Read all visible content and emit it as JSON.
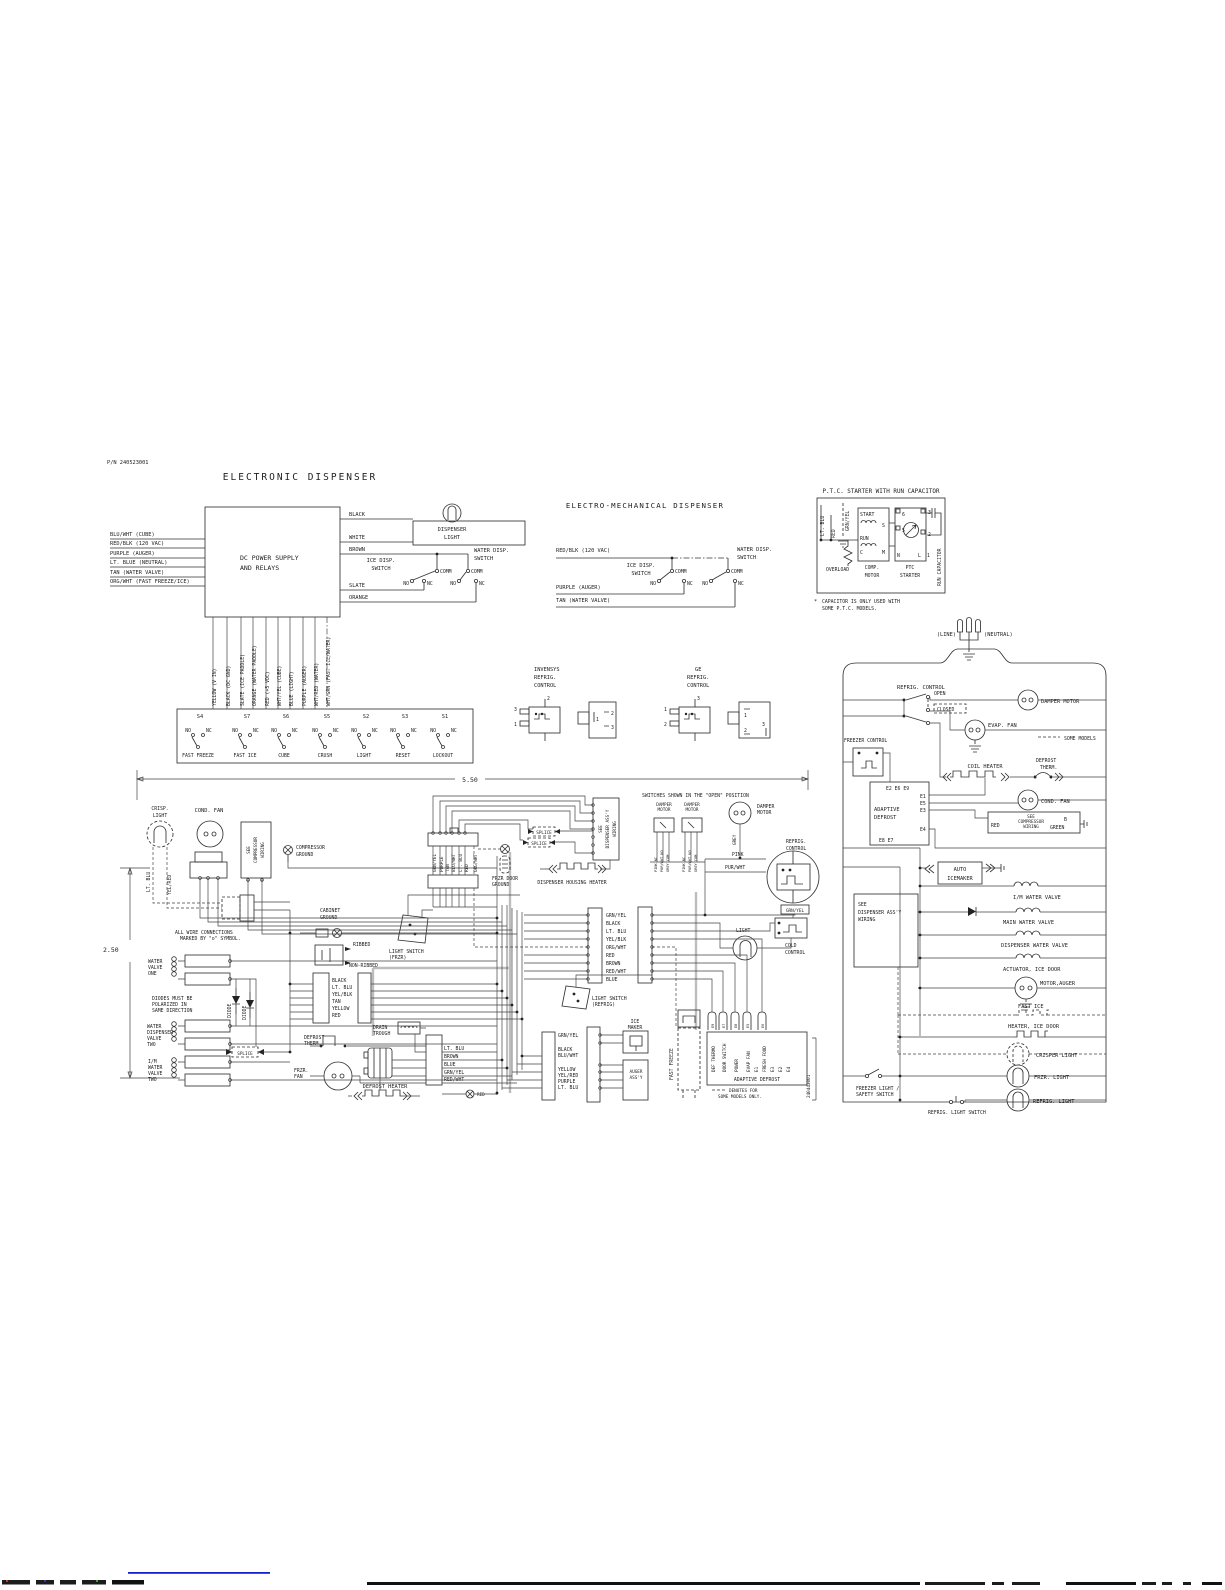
{
  "ed": {
    "pn": "P/N 240523001",
    "title": "ELECTRONIC DISPENSER",
    "box_line1": "DC POWER SUPPLY",
    "box_line2": "AND RELAYS",
    "left_wires": [
      "BLU/WHT (CUBE)",
      "RED/BLK (120 VAC)",
      "PURPLE (AUGER)",
      "LT. BLUE (NEUTRAL)",
      "TAN (WATER VALVE)",
      "ORG/WHT (FAST FREEZE/ICE)"
    ],
    "right_wires": [
      "BLACK",
      "WHITE",
      "BROWN",
      "SLATE",
      "ORANGE"
    ],
    "disp_light1": "DISPENSER",
    "disp_light2": "LIGHT",
    "ice_sw1": "ICE DISP.",
    "ice_sw2": "SWITCH",
    "water_sw1": "WATER DISP.",
    "water_sw2": "SWITCH",
    "comm": "COMM",
    "no": "NO",
    "nc": "NC",
    "bottom_wires": [
      "YELLOW (V IN)",
      "BLACK (DC GND)",
      "SLATE (ICE PADDLE)",
      "ORANGE (WATER PADDLE)",
      "RED (+5 VDC)",
      "WHT/YEL (CUBE)",
      "BLUE (LIGHT)",
      "PURPLE (AUGER)",
      "WHT/RED (WATER)",
      "WHT/GRN (FAST ICE/WATER)"
    ],
    "switches": [
      {
        "id": "S4",
        "label": "FAST FREEZE"
      },
      {
        "id": "S7",
        "label": "FAST ICE"
      },
      {
        "id": "S6",
        "label": "CUBE"
      },
      {
        "id": "S5",
        "label": "CRUSH"
      },
      {
        "id": "S2",
        "label": "LIGHT"
      },
      {
        "id": "S3",
        "label": "RESET"
      },
      {
        "id": "S1",
        "label": "LOCKOUT"
      }
    ]
  },
  "emd": {
    "title": "ELECTRO-MECHANICAL DISPENSER",
    "wire1": "RED/BLK (120 VAC)",
    "wire2": "PURPLE (AUGER)",
    "wire3": "TAN (WATER VALVE)"
  },
  "ptc": {
    "title": "P.T.C. STARTER WITH RUN CAPACITOR",
    "lt_blu": "LT. BLU",
    "red": "RED",
    "grn_yel": "GRN/YEL",
    "overload": "OVERLOAD",
    "start": "START",
    "run": "RUN",
    "s": "S",
    "c": "C",
    "m": "M",
    "n": "N",
    "l": "L",
    "t1": "1",
    "t2": "2",
    "t3": "3",
    "t5": "5",
    "t6": "6",
    "comp1": "COMP.",
    "comp2": "MOTOR",
    "ptc1": "PTC",
    "ptc2": "STARTER",
    "run_cap": "RUN CAPACITOR",
    "star": "*",
    "note1": "CAPACITOR IS ONLY USED WITH",
    "note2": "SOME P.T.C. MODELS."
  },
  "ctl": {
    "inv": "INVENSYS",
    "refrig": "REFRIG.",
    "control": "CONTROL",
    "ge": "GE",
    "n1": "1",
    "n2": "2",
    "n3": "3"
  },
  "cab": {
    "dim_w": "5.50",
    "dim_h": "2.50",
    "crisp1": "CRISP.",
    "crisp2": "LIGHT",
    "lt_blu": "LT. BLU",
    "yel_red": "YEL/RED",
    "cond_fan": "COND. FAN",
    "see_comp1": "SEE",
    "see_comp2": "COMPRESSOR",
    "see_comp3": "WIRING",
    "comp_gnd1": "COMPRESSOR",
    "comp_gnd2": "GROUND",
    "cab_gnd1": "CABINET",
    "cab_gnd2": "GROUND",
    "wire_note1": "ALL WIRE CONNECTIONS",
    "wire_note2": "MARKED BY \"o\" SYMBOL.",
    "wv1": [
      "WATER",
      "VALVE",
      "ONE"
    ],
    "diode_note1": "DIODES MUST BE",
    "diode_note2": "POLARIZED IN",
    "diode_note3": "SAME DIRECTION",
    "diode": "DIODE",
    "wv2": [
      "WATER",
      "DISPENSER",
      "VALVE",
      "TWO"
    ],
    "wv3": [
      "I/M",
      "WATER",
      "VALVE",
      "TWO"
    ],
    "splice": "SPLICE",
    "ribbed": "RIBBED",
    "non_ribbed": "NON-RIBBED",
    "ls_frzr1": "LIGHT SWITCH",
    "ls_frzr2": "(FRZR)",
    "bundle1": [
      "BLACK",
      "LT. BLU",
      "YEL/BLK",
      "TAN",
      "YELLOW",
      "RED"
    ],
    "drain1": "DRAIN",
    "drain2": "TROUGH",
    "def_therm1": "DEFROST",
    "def_therm2": "THERM.",
    "frzr_fan1": "FRZR.",
    "frzr_fan2": "FAN",
    "def_heater": "DEFROST HEATER",
    "bundle2": [
      "LT. BLU",
      "BROWN",
      "BLUE",
      "GRN/YEL",
      "RED/WHT"
    ],
    "red": "RED",
    "top_conn": [
      "GRN/YEL",
      "PURPLE",
      "TAN",
      "BLU/WHT",
      "LT. BLU",
      "RED",
      "ORG/WHT"
    ],
    "frzr_gnd1": "FRZR DOOR",
    "frzr_gnd2": "GROUND",
    "see_disp1": "SEE",
    "see_disp2": "DISPENSER ASS'Y",
    "see_disp3": "WIRING",
    "dhh": "DISPENSER HOUSING HEATER",
    "open_note": "SWITCHES SHOWN IN THE \"OPEN\" POSITION",
    "damper1": "DAMPER",
    "damper2": "MOTOR",
    "sw_pins": [
      "PINK NC",
      "PUR/WHT NO",
      "GREY COM"
    ],
    "grey": "GREY",
    "pink": "PINK",
    "pur_wht": "PUR/WHT",
    "refrig": "REFRIG.",
    "control": "CONTROL",
    "grn_yel": "GRN/YEL",
    "light": "LIGHT",
    "cold1": "COLD",
    "cold2": "CONTROL",
    "ls_ref1": "LIGHT SWITCH",
    "ls_ref2": "(REFRIG)",
    "bundle3": [
      "GRN/YEL",
      "BLACK",
      "LT. BLU",
      "YEL/BLK",
      "ORG/WHT",
      "RED",
      "BROWN",
      "RED/WHT",
      "BLUE"
    ],
    "bundle4": [
      "GRN/YEL",
      "BLACK",
      "BLU/WHT",
      "YELLOW",
      "YEL/RED",
      "PURPLE",
      "LT. BLU"
    ],
    "ice1": "ICE",
    "ice2": "MAKER",
    "auger1": "AUGER",
    "auger2": "ASS'Y",
    "fast_freeze": "FAST FREEZE",
    "ad_plugs": [
      "E9",
      "E7",
      "E8",
      "E5",
      "E6"
    ],
    "ad_cols": [
      "DEF THERMO",
      "DOOR SWITCH",
      "POWER",
      "EVAP FAN",
      "E1",
      "FRESH FOOD",
      "E3",
      "E2",
      "E4"
    ],
    "ad_title": "ADAPTIVE DEFROST",
    "ad_note1": "DENOTES FOR",
    "ad_note2": "SOME MODELS ONLY.",
    "pn_vert": "240443001"
  },
  "rs": {
    "line": "(LINE)",
    "neutral": "(NEUTRAL)",
    "refrig_control": "REFRIG. CONTROL",
    "open": "OPEN",
    "closed": "CLOSED",
    "damper_motor": "DAMPER MOTOR",
    "evap_fan": "EVAP. FAN",
    "some_models": "SOME MODELS",
    "freezer_control": "FREEZER CONTROL",
    "coil_heater": "COIL HEATER",
    "def_therm1": "DEFROST",
    "def_therm2": "THERM.",
    "ad1": "ADAPTIVE",
    "ad2": "DEFROST",
    "e_top": "E2 E6 E9",
    "e1": "E1",
    "e5": "E5",
    "e3": "E3",
    "e4": "E4",
    "e_bot": "E8 E7",
    "cond_fan": "COND. FAN",
    "see_comp1": "SEE",
    "see_comp2": "COMPRESSOR",
    "see_comp3": "WIRING",
    "red": "RED",
    "b": "B",
    "green": "GREEN",
    "auto1": "AUTO",
    "auto2": "ICEMAKER",
    "im_valve": "I/M WATER VALVE",
    "main_valve": "MAIN WATER VALVE",
    "disp_valve": "DISPENSER WATER VALVE",
    "actuator": "ACTUATOR, ICE DOOR",
    "motor_auger": "MOTOR,AUGER",
    "fast_ice": "FAST ICE",
    "heater_ice": "HEATER, ICE DOOR",
    "crisper": "CRISPER LIGHT",
    "frzr_light": "FRZR. LIGHT",
    "refrig_light": "REFRIG. LIGHT",
    "fl1": "FREEZER LIGHT /",
    "fl2": "SAFETY SWITCH",
    "rls": "REFRIG. LIGHT SWITCH",
    "sd1": "SEE",
    "sd2": "DISPENSER ASS'Y",
    "sd3": "WIRING"
  }
}
